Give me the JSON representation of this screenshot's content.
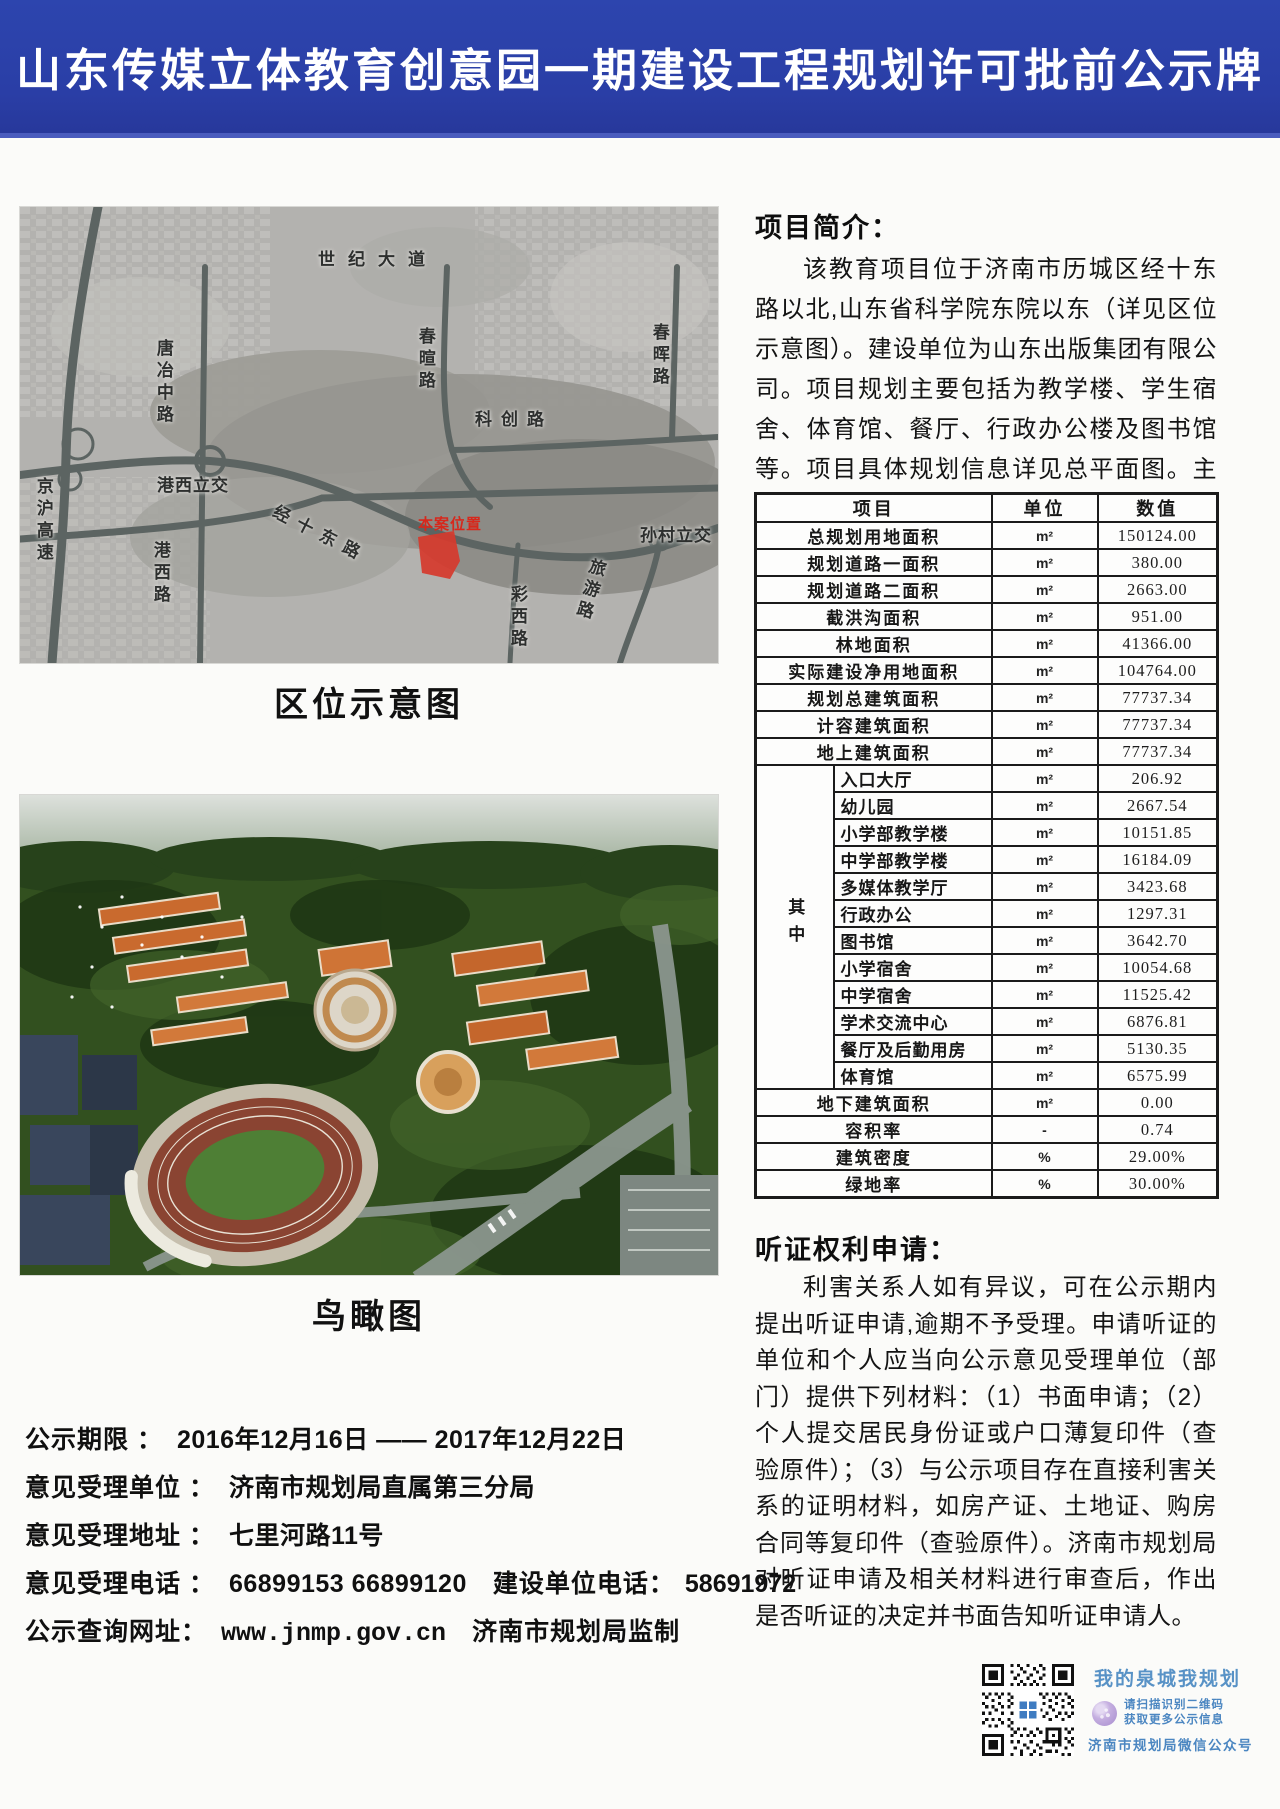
{
  "page": {
    "title": "山东传媒立体教育创意园一期建设工程规划许可批前公示牌"
  },
  "theme": {
    "banner_blue": "#2a3ea6",
    "site_red": "#d7281c",
    "qr_blue": "#4b86c1",
    "road_gray": "#5c6462"
  },
  "left": {
    "location_map": {
      "caption": "区位示意图",
      "site_label": "本案位置",
      "labels": [
        "世纪大道",
        "唐冶中路",
        "春暄路",
        "春晖路",
        "科创路",
        "港西立交",
        "经十东路",
        "孙村立交",
        "京沪高速",
        "港西路",
        "彩西路",
        "旅游路"
      ]
    },
    "aerial": {
      "caption": "鸟瞰图"
    },
    "notice": {
      "rows": [
        {
          "label": "公示期限 ：",
          "value": "2016年12月16日 —— 2017年12月22日",
          "label2": "",
          "value2": ""
        },
        {
          "label": "意见受理单位 ：",
          "value": "济南市规划局直属第三分局",
          "label2": "",
          "value2": ""
        },
        {
          "label": "意见受理地址 ：",
          "value": "七里河路11号",
          "label2": "",
          "value2": ""
        },
        {
          "label": "意见受理电话 ：",
          "value": "66899153 66899120",
          "label2": "建设单位电话：",
          "value2": "58691972"
        },
        {
          "label": "公示查询网址：",
          "value": "www.jnmp.gov.cn",
          "label2": "济南市规划局监制",
          "value2": ""
        }
      ]
    }
  },
  "right": {
    "intro": {
      "heading": "项目简介：",
      "body": "该教育项目位于济南市历城区经十东路以北,山东省科学院东院以东（详见区位示意图）。建设单位为山东出版集团有限公司。项目规划主要包括为教学楼、学生宿舍、体育馆、餐厅、行政办公楼及图书馆等。项目具体规划信息详见总平面图。主要经济指标如下。"
    },
    "table": {
      "headers": [
        "项目",
        "单位",
        "数值"
      ],
      "rows_top": [
        {
          "label": "总规划用地面积",
          "unit": "m²",
          "value": "150124.00"
        },
        {
          "label": "规划道路一面积",
          "unit": "m²",
          "value": "380.00"
        },
        {
          "label": "规划道路二面积",
          "unit": "m²",
          "value": "2663.00"
        },
        {
          "label": "截洪沟面积",
          "unit": "m²",
          "value": "951.00"
        },
        {
          "label": "林地面积",
          "unit": "m²",
          "value": "41366.00"
        },
        {
          "label": "实际建设净用地面积",
          "unit": "m²",
          "value": "104764.00"
        },
        {
          "label": "规划总建筑面积",
          "unit": "m²",
          "value": "77737.34"
        },
        {
          "label": "计容建筑面积",
          "unit": "m²",
          "value": "77737.34"
        },
        {
          "label": "地上建筑面积",
          "unit": "m²",
          "value": "77737.34"
        }
      ],
      "group_label": "其中",
      "rows_sub": [
        {
          "label": "入口大厅",
          "unit": "m²",
          "value": "206.92"
        },
        {
          "label": "幼儿园",
          "unit": "m²",
          "value": "2667.54"
        },
        {
          "label": "小学部教学楼",
          "unit": "m²",
          "value": "10151.85"
        },
        {
          "label": "中学部教学楼",
          "unit": "m²",
          "value": "16184.09"
        },
        {
          "label": "多媒体教学厅",
          "unit": "m²",
          "value": "3423.68"
        },
        {
          "label": "行政办公",
          "unit": "m²",
          "value": "1297.31"
        },
        {
          "label": "图书馆",
          "unit": "m²",
          "value": "3642.70"
        },
        {
          "label": "小学宿舍",
          "unit": "m²",
          "value": "10054.68"
        },
        {
          "label": "中学宿舍",
          "unit": "m²",
          "value": "11525.42"
        },
        {
          "label": "学术交流中心",
          "unit": "m²",
          "value": "6876.81"
        },
        {
          "label": "餐厅及后勤用房",
          "unit": "m²",
          "value": "5130.35"
        },
        {
          "label": "体育馆",
          "unit": "m²",
          "value": "6575.99"
        }
      ],
      "rows_bottom": [
        {
          "label": "地下建筑面积",
          "unit": "m²",
          "value": "0.00"
        },
        {
          "label": "容积率",
          "unit": "-",
          "value": "0.74"
        },
        {
          "label": "建筑密度",
          "unit": "%",
          "value": "29.00%"
        },
        {
          "label": "绿地率",
          "unit": "%",
          "value": "30.00%"
        }
      ]
    },
    "hearing": {
      "heading": "听证权利申请：",
      "body": "利害关系人如有异议，可在公示期内提出听证申请,逾期不予受理。申请听证的单位和个人应当向公示意见受理单位（部门）提供下列材料：（1）书面申请；（2）个人提交居民身份证或户口薄复印件（查验原件）；（3）与公示项目存在直接利害关系的证明材料，如房产证、土地证、购房合同等复印件（查验原件）。济南市规划局对听证申请及相关材料进行审查后，作出是否听证的决定并书面告知听证申请人。"
    },
    "qr": {
      "slogan": "我的泉城我规划",
      "tip1": "请扫描识别二维码",
      "tip2": "获取更多公示信息",
      "account": "济南市规划局微信公众号"
    }
  }
}
